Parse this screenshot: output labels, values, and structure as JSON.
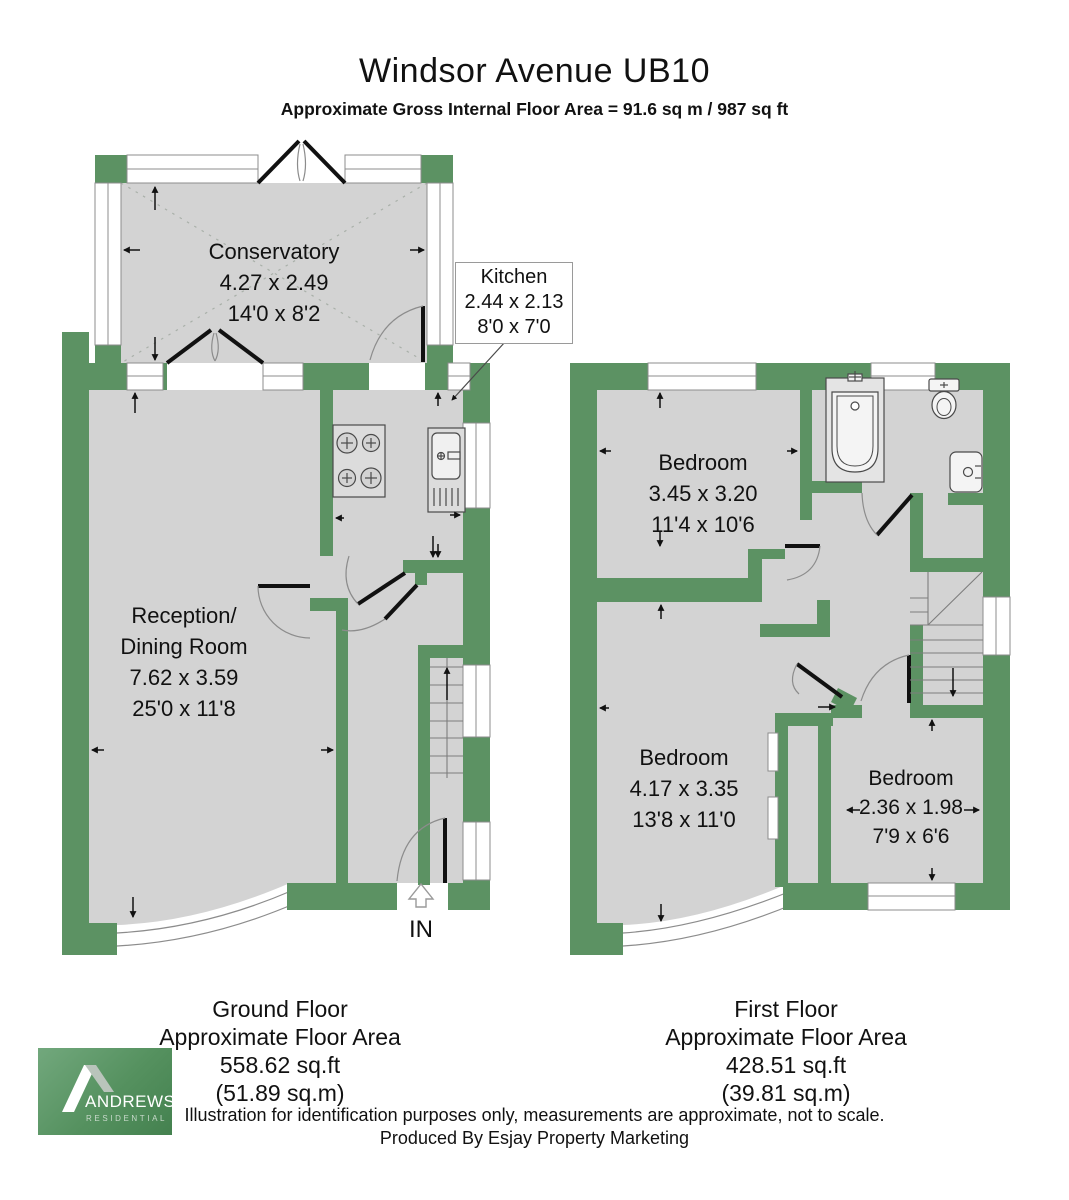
{
  "title": "Windsor Avenue UB10",
  "subtitle": "Approximate Gross Internal Floor Area = 91.6 sq m / 987 sq ft",
  "colors": {
    "wall_green": "#5c9263",
    "floor_gray": "#d3d3d3",
    "logo_green": "#55915f"
  },
  "ground_floor": {
    "rooms": {
      "conservatory": {
        "name": "Conservatory",
        "metric": "4.27 x 2.49",
        "imperial": "14'0 x 8'2"
      },
      "kitchen": {
        "name": "Kitchen",
        "metric": "2.44 x 2.13",
        "imperial": "8'0 x 7'0"
      },
      "reception": {
        "name_line1": "Reception/",
        "name_line2": "Dining Room",
        "metric": "7.62 x 3.59",
        "imperial": "25'0 x 11'8"
      }
    },
    "entrance_label": "IN",
    "summary": [
      "Ground Floor",
      "Approximate Floor Area",
      "558.62 sq.ft",
      "(51.89 sq.m)"
    ]
  },
  "first_floor": {
    "rooms": {
      "bedroom1": {
        "name": "Bedroom",
        "metric": "3.45 x 3.20",
        "imperial": "11'4 x 10'6"
      },
      "bedroom2": {
        "name": "Bedroom",
        "metric": "4.17 x 3.35",
        "imperial": "13'8 x 11'0"
      },
      "bedroom3": {
        "name": "Bedroom",
        "metric": "2.36 x 1.98",
        "imperial": "7'9 x 6'6"
      }
    },
    "summary": [
      "First Floor",
      "Approximate Floor Area",
      "428.51 sq.ft",
      "(39.81 sq.m)"
    ]
  },
  "footer": {
    "disclaimer": "Illustration for identification purposes only, measurements are approximate, not to scale.",
    "produced_by": "Produced By Esjay Property Marketing"
  },
  "logo": {
    "brand": "ANDREWS",
    "division": "RESIDENTIAL"
  }
}
